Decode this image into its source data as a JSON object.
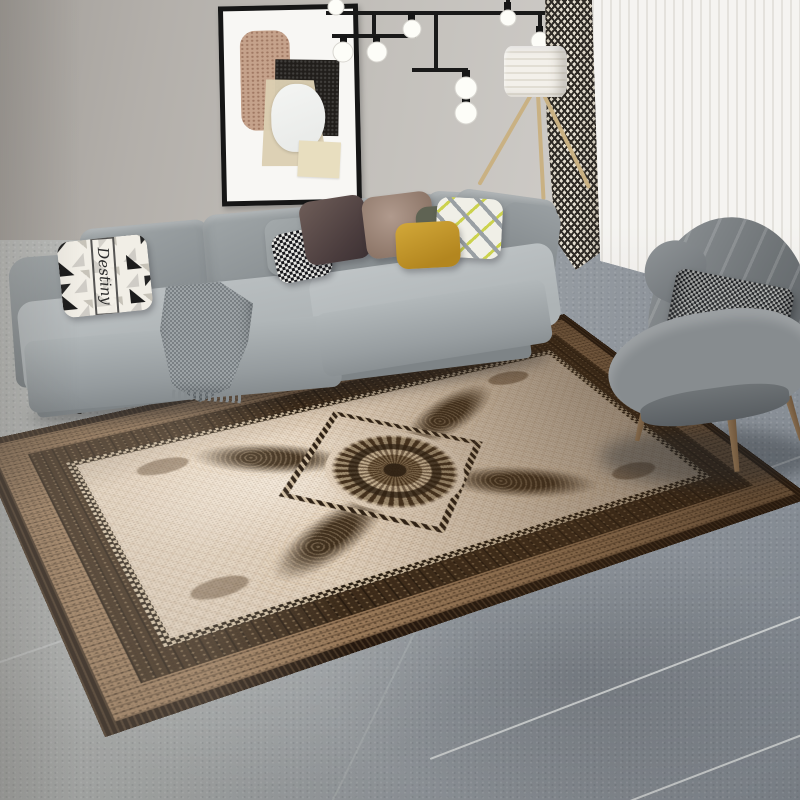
{
  "scene": {
    "description": "Photo of a modern living room: gray L-shaped sectional sofa with decorative pillows, abstract wall art, black linear chandelier, tripod floor lamp, chevron and sheer curtains, gray wingback armchair, and a large vintage ornate medallion rug on gray tile flooring.",
    "wall": {
      "color_left": "#a39f9a",
      "color_right": "#d8d6d2"
    },
    "artwork": {
      "frame_color": "#161616",
      "mat_color": "#f8f7f4",
      "shapes": [
        "tan speckled rounded block",
        "black textured block",
        "beige trapezoid sheet",
        "white oval",
        "small beige sheet"
      ]
    },
    "chandelier": {
      "style": "modern linear black rods",
      "rod_color": "#191919",
      "globe_color": "#fdfdf8",
      "bulb_count": 8
    },
    "floor_lamp": {
      "shade_color": "#f0ede6",
      "leg_color": "#c9b183",
      "legs": 3
    },
    "curtains": {
      "patterned": {
        "pattern": "black and cream chevron weave",
        "colors": [
          "#2e2a25",
          "#e9e3d5"
        ]
      },
      "sheer": {
        "color": "#f7f6f4"
      }
    },
    "sofa": {
      "type": "L-shaped sectional",
      "fabric_color": "#aab0b3",
      "back_cushion_color": "#969c9f",
      "leg_color": "#33312e"
    },
    "pillows": [
      {
        "name": "script-pillow",
        "text": "Destiny",
        "colors": [
          "#f1eee6",
          "#1c1c1c"
        ]
      },
      {
        "name": "gray-pillow",
        "colors": [
          "#9aa0a2"
        ]
      },
      {
        "name": "houndstooth-pillow",
        "colors": [
          "#17171b",
          "#e8e8e4"
        ]
      },
      {
        "name": "plum-pillow",
        "colors": [
          "#5c4c49"
        ]
      },
      {
        "name": "mauve-pillow",
        "colors": [
          "#a78f83"
        ]
      },
      {
        "name": "sage-pillow",
        "colors": [
          "#5f6353"
        ]
      },
      {
        "name": "zigzag-pillow",
        "colors": [
          "#f0efe7",
          "#9aa0a4",
          "#ccd24e"
        ]
      },
      {
        "name": "mustard-pillow",
        "colors": [
          "#c79a2f"
        ]
      }
    ],
    "throw_blanket": {
      "pattern": "houndstooth",
      "colors": [
        "#9da3a6",
        "#7a8084"
      ]
    },
    "armchair": {
      "type": "wingback channel-tufted",
      "fabric_color": "#7d8286",
      "pillow": "dark houndstooth",
      "leg_color": "#7a6148"
    },
    "rug": {
      "style": "vintage oriental medallion",
      "field_color": "#e8d7c2",
      "border_outer_color": "#26190f",
      "border_tan_color": "#a2805e",
      "border_inner_color": "#3f2d1b",
      "trim": "black and cream checker",
      "medallion_color": "#4a3520",
      "ornament_layout": "central round medallion in diamond frame with four diagonal baroque arms and corner motifs"
    },
    "floor": {
      "type": "large gray tiles",
      "color_left": "#bcbdba",
      "color_right": "#848b93",
      "grout_color": "#e4e6e5"
    }
  },
  "palette": {
    "accent_mustard": "#c79a2f",
    "accent_zigzag_green": "#ccd24e",
    "dark_rug_brown": "#26190f",
    "cream": "#e8d7c2",
    "sofa_gray": "#aab0b3"
  }
}
